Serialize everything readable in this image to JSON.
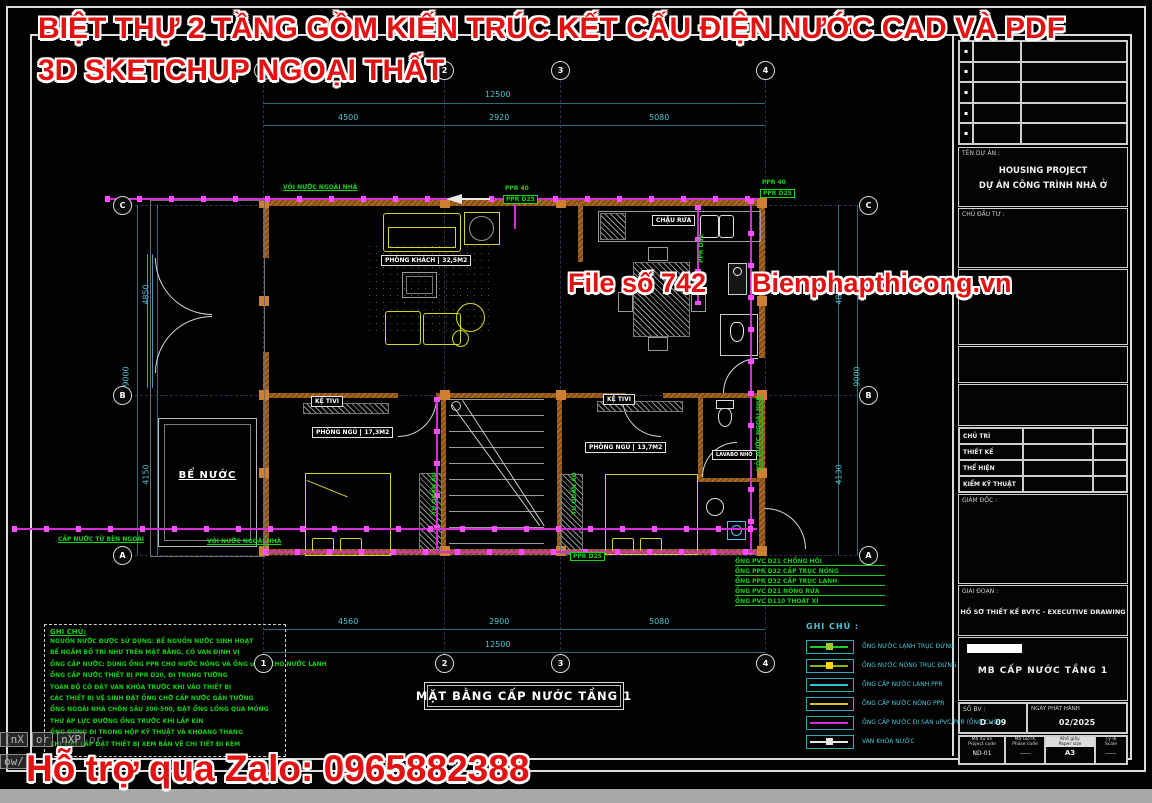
{
  "colors": {
    "background": "#020202",
    "frame": "#dcdcdc",
    "wall_orange": "#8a5115",
    "column_orange": "#cd7f32",
    "furniture_yellow": "#d4d428",
    "pipe_magenta": "#d92ad9",
    "marker_magenta": "#ff4dff",
    "note_green": "#17cf17",
    "dim_cyan": "#4fc3d4",
    "legend_cyan": "#49c8d8",
    "watermark_red": "#e31212"
  },
  "watermark": {
    "line1": "BIỆT THỰ 2 TẦNG GỒM KIẾN TRÚC KẾT CẤU ĐIỆN NƯỚC CAD VÀ PDF",
    "line2": "3D SKETCHUP NGOẠI THẤT",
    "file_no": "File số 742",
    "site": "Bienphapthicong.vn",
    "zalo": "Hỗ trợ qua Zalo: 0965882388"
  },
  "cad_prompt": {
    "t1": "(nX",
    "t2": "or",
    "t3": "nXP",
    "t4": "or",
    "l2": "ow/"
  },
  "titleblock": {
    "rev_symbols": [
      "▪",
      "▪",
      "▪",
      "▪",
      "▪"
    ],
    "ten_du_an_label": "TÊN DỰ ÁN :",
    "project_en": "HOUSING PROJECT",
    "project_vi": "DỰ ÁN CÔNG TRÌNH NHÀ Ở",
    "chu_dau_tu_label": "CHỦ ĐẦU TƯ :",
    "staff": [
      "CHỦ TRÌ",
      "THIẾT KẾ",
      "THỂ HIỆN",
      "KIỂM KỸ THUẬT"
    ],
    "giam_doc_label": "GIÁM ĐỐC :",
    "giai_doan_label": "GIAI ĐOẠN :",
    "giai_doan_value": "HỒ SƠ THIẾT KẾ BVTC - EXECUTIVE DRAWING",
    "drawing_name": "MB CẤP NƯỚC TẦNG 1",
    "sheet_label": "SỐ BV :",
    "sheet_no": "D - 09",
    "issue_label": "NGÀY PHÁT HÀNH",
    "issue_date": "02/2025",
    "footer": [
      {
        "l1": "Mã dự án",
        "l2": "Project code",
        "v": "ND-01"
      },
      {
        "l1": "Mã GĐTK",
        "l2": "Phase code",
        "v": "-----"
      },
      {
        "l1": "Khổ giấy",
        "l2": "Paper size",
        "v": "A3"
      },
      {
        "l1": "Tỷ lệ",
        "l2": "Scale",
        "v": "-----"
      }
    ]
  },
  "plan": {
    "title": "MẶT BẰNG CẤP NƯỚC TẦNG 1",
    "grid": {
      "cols": [
        "1",
        "2",
        "3",
        "4"
      ],
      "rows": [
        "C",
        "B",
        "A"
      ]
    },
    "dims": {
      "top": [
        "4500",
        "2920",
        "5080"
      ],
      "top_total": "12500",
      "bottom": [
        "4560",
        "2900",
        "5080"
      ],
      "bottom_total": "12500",
      "left": [
        "4850",
        "4150"
      ],
      "left_total": "9000",
      "right": [
        "4850",
        "4130"
      ],
      "right_total": "9000"
    },
    "rooms": {
      "living": {
        "name": "PHÒNG KHÁCH",
        "area": "32,5M2"
      },
      "bed1": {
        "name": "PHÒNG NGỦ",
        "area": "17,3M2"
      },
      "bed2": {
        "name": "PHÒNG NGỦ",
        "area": "13,7M2"
      }
    },
    "labels": {
      "sink": "CHẬU RỬA",
      "tv": "KỆ TIVI",
      "tank": "BỂ NƯỚC",
      "lavabo": "LAVABO NHỎ",
      "wardrobe": "TỦ QUẦN ÁO"
    },
    "green": {
      "faucet": "VỎI NƯỚC NGOÀI NHÀ",
      "supply": "CẤP NƯỚC TỪ BÊN NGOÀI",
      "ppr40": "PPR 40",
      "ppr25": "PPR D25",
      "ppr32": "PPR D32"
    },
    "callouts": [
      "ỐNG PVC D21 CHỐNG HÔI",
      "ỐNG PPR D32 CẤP TRỤC NÓNG",
      "ỐNG PPR D32 CẤP TRỤC LẠNH",
      "ỐNG PVC D21 NÓNG RỬA",
      "ỐNG PVC D110 THOÁT XÍ"
    ]
  },
  "legend": {
    "title": "GHI CHÚ :",
    "rows": [
      {
        "label": "ỐNG NƯỚC LẠNH TRỤC ĐỨNG",
        "color": "#22cc22"
      },
      {
        "label": "ỐNG NƯỚC NÓNG TRỤC ĐỨNG",
        "color": "#8db600"
      },
      {
        "label": "ỐNG CẤP NƯỚC LẠNH PPR",
        "color": "#26c6da"
      },
      {
        "label": "ỐNG CẤP NƯỚC NÓNG PPR",
        "color": "#d4c52a"
      },
      {
        "label": "ỐNG CẤP NƯỚC ĐI SÀN uPVC/PPR (ỐNG CHỜ)",
        "color": "#d82ad8"
      },
      {
        "label": "VAN KHÓA NƯỚC",
        "color": "#e8e8e8"
      }
    ]
  },
  "notes": {
    "title": "GHI CHÚ:",
    "lines": [
      "NGUỒN NƯỚC ĐƯỢC SỬ DỤNG: BỂ NGUỒN NƯỚC SINH HOẠT",
      "BỂ NGẦM BỐ TRÍ NHƯ TRÊN MẶT BẰNG, CÓ VAN ĐỊNH VỊ",
      "ỐNG CẤP NƯỚC: DÙNG ỐNG PPR CHO NƯỚC NÓNG VÀ ỐNG uPVC CHO NƯỚC LẠNH",
      "ỐNG CẤP NƯỚC THIẾT BỊ PPR D20, ĐI TRONG TƯỜNG",
      "TOÀN BỘ CÓ ĐẶT VAN KHÓA TRƯỚC KHI VÀO THIẾT BỊ",
      "CÁC THIẾT BỊ VỆ SINH ĐẶT ỐNG CHỜ CẤP NƯỚC GẮN TƯỜNG",
      "ỐNG NGOÀI NHÀ CHÔN SÂU 300-500, ĐẶT ỐNG LỒNG QUA MÓNG",
      "THỬ ÁP LỰC ĐƯỜNG ỐNG TRƯỚC KHI LẤP KÍN",
      "ỐNG ĐỨNG ĐI TRONG HỘP KỸ THUẬT VÀ KHOANG THANG",
      "CHI TIẾT LẮP ĐẶT THIẾT BỊ XEM BẢN VẼ CHI TIẾT ĐI KÈM"
    ]
  }
}
